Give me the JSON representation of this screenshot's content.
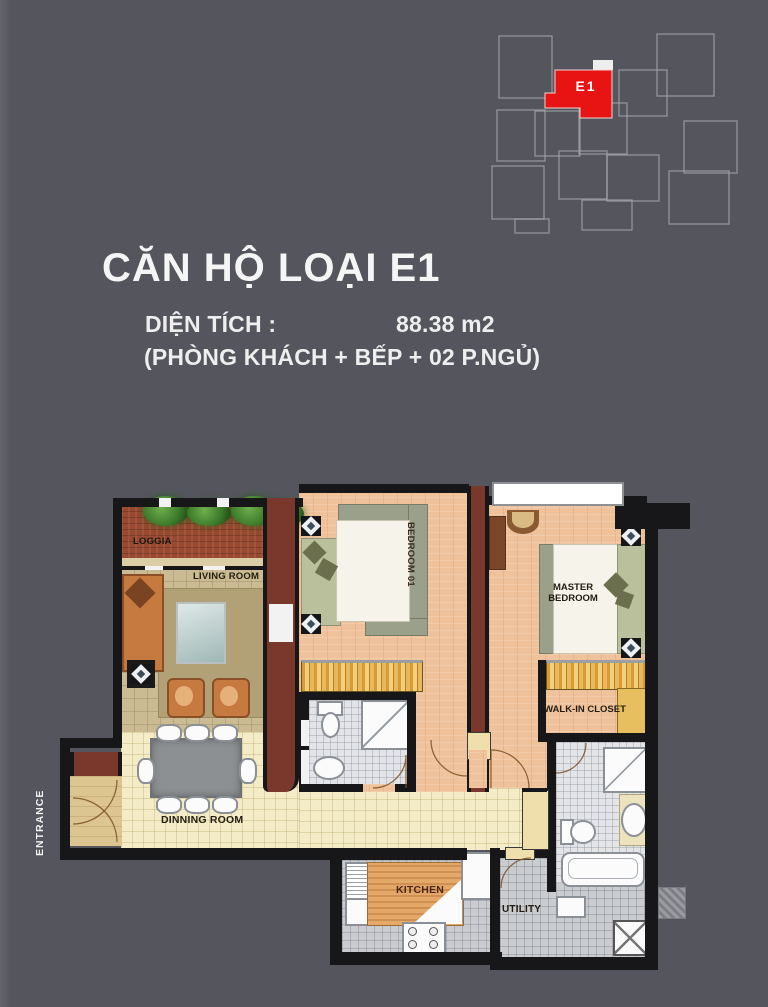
{
  "background": "#55565d",
  "keyplan": {
    "unit_label": "E1",
    "highlight_color": "#e81414",
    "outline_color": "#a3a4aa"
  },
  "header": {
    "title": "CĂN HỘ LOẠI E1",
    "area_label": "DIỆN TÍCH :",
    "area_value": "88.38 m2",
    "composition": "(PHÒNG KHÁCH + BẾP + 02 P.NGỦ)"
  },
  "floorplan": {
    "rooms": [
      {
        "id": "loggia",
        "label": "LOGGIA"
      },
      {
        "id": "living-room",
        "label": "LIVING ROOM"
      },
      {
        "id": "bedroom-01",
        "label": "BEDROOM 01"
      },
      {
        "id": "master-bedroom",
        "label": "MASTER BEDROOM"
      },
      {
        "id": "walk-in-closet",
        "label": "WALK-IN CLOSET"
      },
      {
        "id": "dinning-room",
        "label": "DINNING ROOM"
      },
      {
        "id": "kitchen",
        "label": "KITCHEN"
      },
      {
        "id": "utility",
        "label": "UTILITY"
      },
      {
        "id": "entrance",
        "label": "ENTRANCE"
      }
    ],
    "colors": {
      "wall": "#17171a",
      "accent_wall": "#7a382c",
      "bedroom_floor": "#efc29b",
      "hall_floor": "#f4ecc6",
      "living_floor": "#cabb92",
      "tile_floor": "#e3e4e7",
      "loggia_floor": "#98492f",
      "wardrobe": "#e8b95c"
    }
  }
}
